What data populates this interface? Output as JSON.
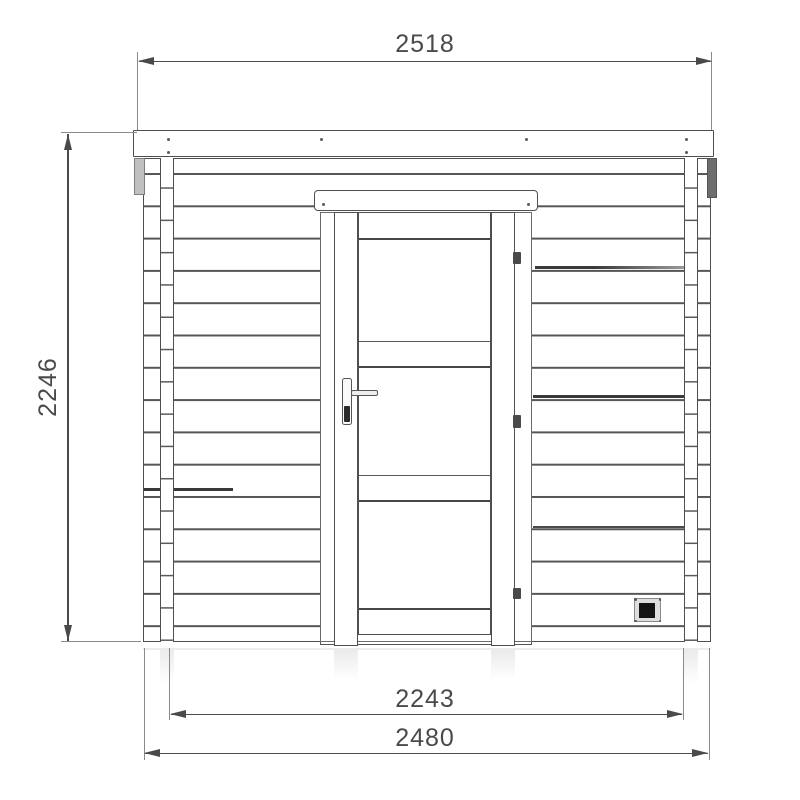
{
  "drawing": {
    "labels": {
      "top_width": "2518",
      "left_height": "2246",
      "inner_width": "2243",
      "overall_width": "2480"
    },
    "colors": {
      "background": "#ffffff",
      "line": "#4f4f4f",
      "plank_line": "#565656",
      "dimension": "#4a4a4a",
      "vent_fill": "#141414"
    }
  }
}
